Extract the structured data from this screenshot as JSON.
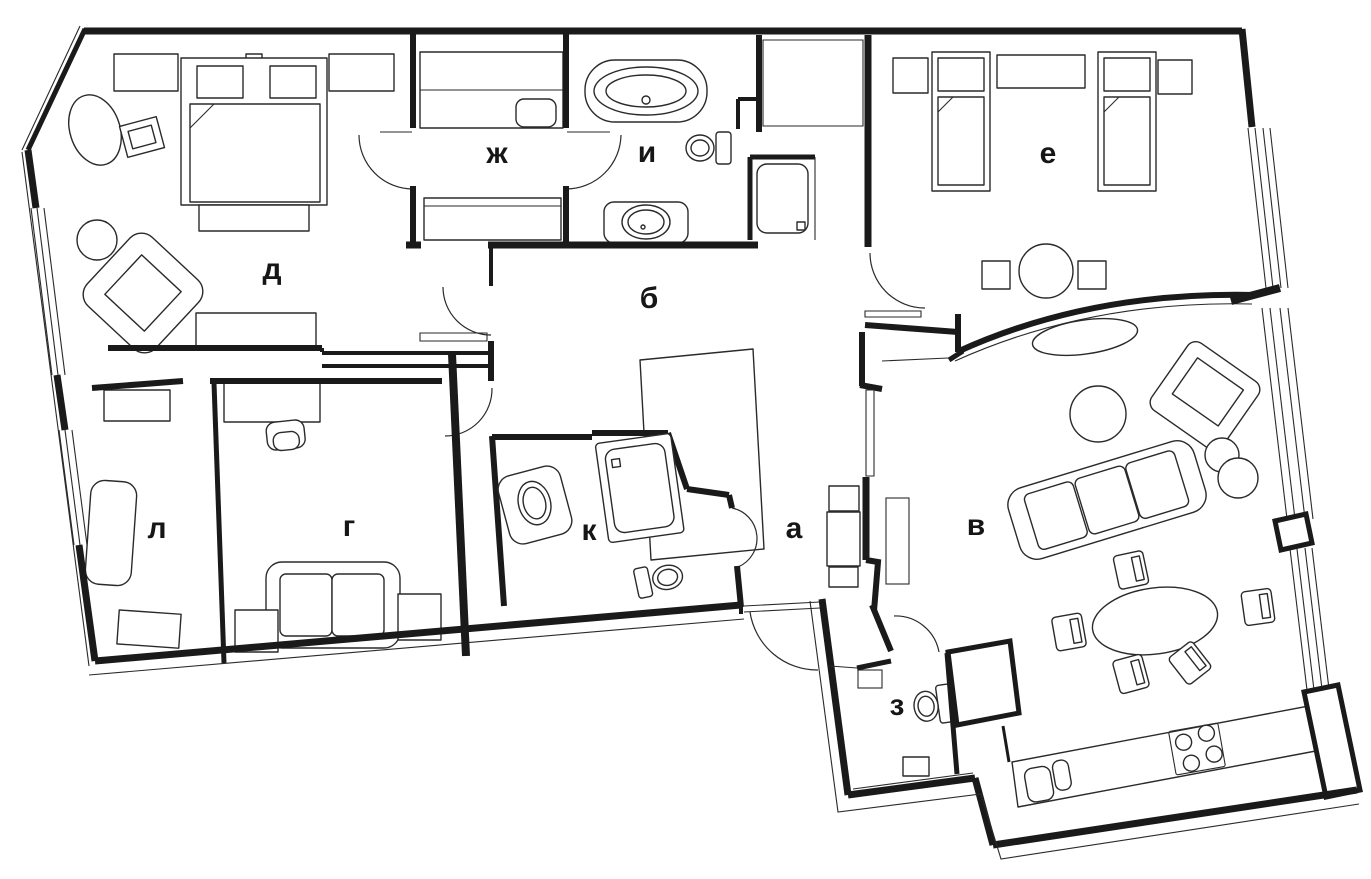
{
  "plan": {
    "kind": "apartment floor plan drawing",
    "colors": {
      "ink": "#1a1a1a",
      "background": "#ffffff"
    }
  },
  "rooms": [
    {
      "id": "a",
      "label": "а"
    },
    {
      "id": "b",
      "label": "б"
    },
    {
      "id": "v",
      "label": "в"
    },
    {
      "id": "g",
      "label": "г"
    },
    {
      "id": "d",
      "label": "д"
    },
    {
      "id": "e",
      "label": "е"
    },
    {
      "id": "zh",
      "label": "ж"
    },
    {
      "id": "z",
      "label": "з"
    },
    {
      "id": "i",
      "label": "и"
    },
    {
      "id": "k",
      "label": "к"
    },
    {
      "id": "l",
      "label": "л"
    }
  ]
}
